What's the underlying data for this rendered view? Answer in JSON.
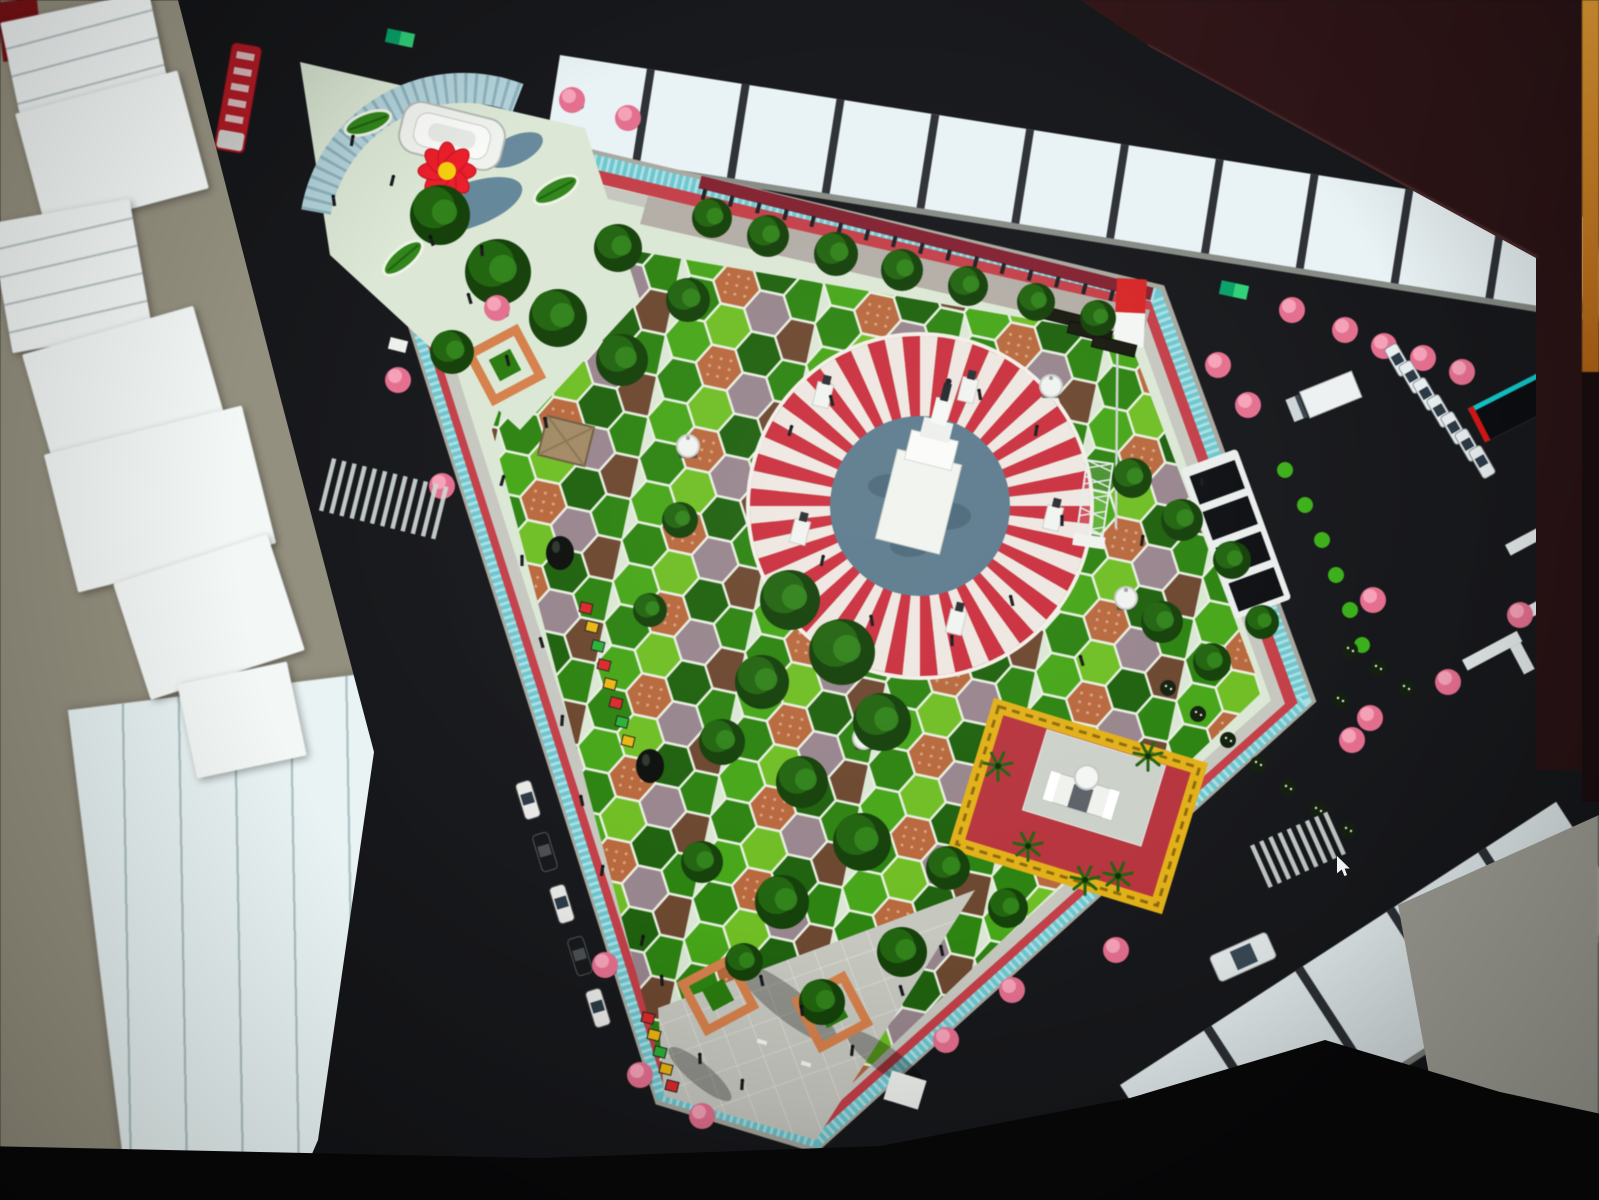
{
  "scene": {
    "type": "photograph of a monitor displaying a 3D aerial render of a town-square park",
    "cursor": {
      "x": 1337,
      "y": 856
    }
  },
  "colors": {
    "room_tan": "#94907f",
    "paper": "#f3f7f6",
    "lined_paper": "#e9f3f3",
    "lined_paper_line": "#a4b8bc",
    "asphalt": "#17181b",
    "building_white": "#e9f2f4",
    "building_gap": "#2d3136",
    "curb": "#9aa098",
    "sidewalk": "#a8a89f",
    "teal_strip": "#6fc6ce",
    "teal_dash": "#eaf6f6",
    "track_red": "#bf4049",
    "walk_light": "#c6c8c0",
    "mint": "#dce8d6",
    "wall_red": "#7e2230",
    "path_gray": "#b3ada6",
    "plaza_gray": "#c6c8c0",
    "grid_line": "#e8eae4",
    "hex_bright": "#49a51d",
    "hex_mid": "#2f8214",
    "hex_dark": "#206010",
    "hex_lime": "#71bd2a",
    "hex_terra": "#b5693f",
    "hex_mauve": "#97858d",
    "hex_brown": "#6b4730",
    "hex_grout": "#e9f0e4",
    "sun_red": "#c5313f",
    "sun_white": "#efe7e1",
    "pool": "#5d7b8c",
    "pool_dark": "#46616f",
    "monument": "#f2f4f0",
    "gate_red": "#b2353f",
    "gate_yellow": "#e0b01f",
    "court_gray": "#ccd1ca",
    "tree_dark": "#153f0b",
    "tree_mid": "#236312",
    "tree_light": "#358420",
    "pink": "#e0708f",
    "pink_light": "#f2a3b8",
    "flag_red": "#d02828",
    "white": "#f2f4f2",
    "amph_blue": "#b5d3da",
    "amph_dash": "#6f97a2",
    "pond": "#5b7f95",
    "cursor_white": "#f5f7f7",
    "billboard_teal": "#19c8c8",
    "billboard_red": "#d01818",
    "sign_green_a": "#0fa06a",
    "sign_green_b": "#35d07a",
    "bus_red": "#b51e28",
    "stall_red": "#d42b2b",
    "stall_yellow": "#e8b619",
    "stall_green": "#2fae3a",
    "planter_orange": "#d2814e",
    "roof_tan": "#a08a66",
    "dark_struct": "#17190f"
  },
  "park": {
    "pent": [
      [
        340,
        95
      ],
      [
        1160,
        290
      ],
      [
        1310,
        700
      ],
      [
        815,
        1147
      ],
      [
        660,
        1100
      ]
    ],
    "teal": [
      [
        348,
        103
      ],
      [
        1155,
        296
      ],
      [
        1303,
        700
      ],
      [
        816,
        1140
      ],
      [
        663,
        1094
      ]
    ],
    "red": [
      [
        363,
        121
      ],
      [
        1146,
        307
      ],
      [
        1290,
        701
      ],
      [
        817,
        1125
      ],
      [
        669,
        1081
      ]
    ],
    "walk": [
      [
        376,
        139
      ],
      [
        1139,
        316
      ],
      [
        1278,
        702
      ],
      [
        818,
        1113
      ],
      [
        674,
        1070
      ]
    ],
    "hexf": [
      [
        560,
        238
      ],
      [
        1128,
        336
      ],
      [
        1262,
        692
      ],
      [
        816,
        1118
      ],
      [
        660,
        1062
      ],
      [
        492,
        430
      ]
    ],
    "mintp": [
      [
        300,
        62
      ],
      [
        585,
        128
      ],
      [
        640,
        300
      ],
      [
        520,
        430
      ],
      [
        330,
        255
      ]
    ],
    "nepath": [
      [
        648,
        196
      ],
      [
        1150,
        310
      ],
      [
        1142,
        338
      ],
      [
        640,
        224
      ]
    ],
    "splaza": [
      [
        658,
        1008
      ],
      [
        975,
        890
      ],
      [
        816,
        1140
      ],
      [
        664,
        1096
      ]
    ],
    "wall": [
      700,
      182,
      1152,
      294
    ],
    "circle": {
      "cx": 920,
      "cy": 506,
      "r_out": 170,
      "r_pool": 90
    }
  },
  "buildings": {
    "top": {
      "x": 560,
      "y": 55,
      "rot": 9,
      "len": 1100,
      "h": 95,
      "block": 88,
      "gap": 8
    },
    "bottom": {
      "x": 1120,
      "y": 1085,
      "rot": -33,
      "len": 520,
      "h": 135,
      "block": 100,
      "gap": 9
    }
  },
  "trees_dark": [
    [
      440,
      215,
      30
    ],
    [
      498,
      272,
      33
    ],
    [
      558,
      318,
      29
    ],
    [
      622,
      360,
      26
    ],
    [
      452,
      352,
      22
    ],
    [
      618,
      248,
      24
    ],
    [
      688,
      300,
      22
    ],
    [
      712,
      218,
      20
    ],
    [
      768,
      236,
      21
    ],
    [
      836,
      254,
      22
    ],
    [
      902,
      270,
      21
    ],
    [
      968,
      286,
      20
    ],
    [
      1036,
      302,
      19
    ],
    [
      1098,
      318,
      18
    ],
    [
      790,
      600,
      30
    ],
    [
      842,
      652,
      33
    ],
    [
      762,
      682,
      27
    ],
    [
      882,
      722,
      29
    ],
    [
      802,
      782,
      26
    ],
    [
      722,
      742,
      23
    ],
    [
      862,
      842,
      29
    ],
    [
      782,
      902,
      27
    ],
    [
      702,
      862,
      21
    ],
    [
      902,
      952,
      25
    ],
    [
      822,
      1002,
      23
    ],
    [
      744,
      962,
      19
    ],
    [
      1132,
      478,
      20
    ],
    [
      1182,
      520,
      21
    ],
    [
      1232,
      560,
      19
    ],
    [
      1162,
      622,
      21
    ],
    [
      1212,
      662,
      19
    ],
    [
      1262,
      622,
      17
    ],
    [
      948,
      868,
      22
    ],
    [
      1008,
      908,
      20
    ],
    [
      680,
      520,
      18
    ],
    [
      650,
      610,
      17
    ]
  ],
  "trees_pink": [
    [
      572,
      100
    ],
    [
      628,
      118
    ],
    [
      398,
      380
    ],
    [
      442,
      486
    ],
    [
      605,
      965
    ],
    [
      640,
      1075
    ],
    [
      702,
      1116
    ],
    [
      946,
      1040
    ],
    [
      1012,
      990
    ],
    [
      1116,
      950
    ],
    [
      1218,
      365
    ],
    [
      1248,
      405
    ],
    [
      1292,
      310
    ],
    [
      1345,
      330
    ],
    [
      1384,
      346
    ],
    [
      1423,
      358
    ],
    [
      1462,
      372
    ],
    [
      1373,
      600
    ],
    [
      1352,
      740
    ],
    [
      1448,
      682
    ],
    [
      1520,
      615
    ],
    [
      1552,
      600
    ],
    [
      1370,
      718
    ],
    [
      497,
      308
    ]
  ],
  "shrubs_bright": [
    [
      1285,
      470
    ],
    [
      1305,
      505
    ],
    [
      1322,
      540
    ],
    [
      1336,
      575
    ],
    [
      1350,
      610
    ],
    [
      1362,
      645
    ]
  ],
  "shrubs_dark": [
    [
      1168,
      688
    ],
    [
      1198,
      714
    ],
    [
      1228,
      740
    ],
    [
      1258,
      764
    ],
    [
      1288,
      788
    ],
    [
      1318,
      810
    ],
    [
      1348,
      830
    ],
    [
      1350,
      650
    ],
    [
      1378,
      668
    ],
    [
      1406,
      688
    ],
    [
      1340,
      700
    ],
    [
      1368,
      718
    ]
  ],
  "palms": [
    [
      998,
      766
    ],
    [
      1028,
      846
    ],
    [
      1118,
      876
    ],
    [
      1148,
      756
    ],
    [
      1085,
      880
    ]
  ],
  "people": [
    [
      352,
      142
    ],
    [
      392,
      182
    ],
    [
      334,
      202
    ],
    [
      432,
      242
    ],
    [
      470,
      300
    ],
    [
      508,
      362
    ],
    [
      482,
      252
    ],
    [
      546,
      424
    ],
    [
      502,
      482
    ],
    [
      522,
      562
    ],
    [
      542,
      644
    ],
    [
      562,
      722
    ],
    [
      582,
      802
    ],
    [
      602,
      872
    ],
    [
      790,
      432
    ],
    [
      832,
      402
    ],
    [
      980,
      396
    ],
    [
      1036,
      432
    ],
    [
      1062,
      522
    ],
    [
      1012,
      602
    ],
    [
      952,
      642
    ],
    [
      872,
      622
    ],
    [
      822,
      562
    ],
    [
      762,
      982
    ],
    [
      802,
      1012
    ],
    [
      852,
      1052
    ],
    [
      902,
      992
    ],
    [
      942,
      952
    ],
    [
      1082,
      662
    ],
    [
      1142,
      542
    ],
    [
      1202,
      482
    ],
    [
      642,
      942
    ],
    [
      662,
      982
    ],
    [
      700,
      1060
    ],
    [
      742,
      1086
    ]
  ],
  "pedestals": [
    [
      823,
      395
    ],
    [
      968,
      390
    ],
    [
      800,
      532
    ],
    [
      1053,
      518
    ],
    [
      956,
      622
    ]
  ],
  "gazebos_dome": [
    [
      688,
      446
    ],
    [
      1051,
      386
    ],
    [
      1126,
      598
    ],
    [
      864,
      738
    ]
  ],
  "black_domes": [
    [
      560,
      553
    ],
    [
      650,
      766
    ]
  ],
  "leaf_planters": [
    [
      368,
      123,
      -20
    ],
    [
      403,
      258,
      -40
    ],
    [
      556,
      190,
      -28
    ]
  ],
  "planters_diamond": [
    [
      718,
      995
    ],
    [
      832,
      1012
    ],
    [
      505,
      365
    ]
  ],
  "stall_rows": [
    {
      "x": 586,
      "y": 608,
      "dx": 6,
      "dy": 19,
      "colors": [
        "stall_red",
        "stall_yellow",
        "stall_green",
        "stall_red",
        "stall_yellow",
        "stall_red",
        "stall_green",
        "stall_yellow"
      ]
    },
    {
      "x": 648,
      "y": 1018,
      "dx": 6,
      "dy": 17,
      "colors": [
        "stall_red",
        "stall_yellow",
        "stall_green",
        "stall_yellow",
        "stall_red"
      ]
    }
  ],
  "stage_rows": [
    [
      1066,
      318
    ],
    [
      1090,
      332
    ],
    [
      1114,
      346
    ]
  ],
  "benches": [
    [
      762,
      1042
    ],
    [
      806,
      1064
    ],
    [
      726,
      1000
    ]
  ],
  "white_sign_plaza": [
    905,
    1090
  ],
  "kiosk": [
    398,
    345
  ],
  "shadow_blobs": [
    [
      788,
      1004,
      62,
      16,
      38
    ],
    [
      886,
      1060,
      48,
      13,
      36
    ],
    [
      700,
      1074,
      40,
      11,
      40
    ]
  ],
  "grid_lines_a": {
    "x0": 600,
    "y0": 860,
    "dx": 120,
    "dy": 320,
    "step": 30,
    "n": 9
  },
  "grid_lines_b": {
    "x0": 640,
    "y0": 930,
    "dx": 340,
    "dy": -120,
    "step": 34,
    "n": 7
  },
  "vehicles": {
    "bus": {
      "x": 238,
      "y": 98,
      "rot": 10
    },
    "van": {
      "x": 1243,
      "y": 957,
      "rot": -24
    },
    "truck": {
      "x": 1327,
      "y": 396,
      "rot": 68
    },
    "parked_right": {
      "x": 1398,
      "y": 360,
      "dx": 14,
      "dy": 17,
      "count": 7,
      "rot": 60
    },
    "parked_left": {
      "pts": [
        [
          528,
          800
        ],
        [
          545,
          852
        ],
        [
          562,
          904
        ],
        [
          580,
          956
        ],
        [
          598,
          1008
        ]
      ],
      "rot": 73,
      "colors": [
        "#e8e8e6",
        "#17181b",
        "#e8e8e6",
        "#17181b",
        "#e8e8e6"
      ]
    }
  },
  "crosswalks": [
    {
      "x": 332,
      "y": 458,
      "rot": 14,
      "bars": 12,
      "w": 4.5,
      "h": 54,
      "step": 10.5
    },
    {
      "x": 1250,
      "y": 846,
      "rot": -24,
      "bars": 9,
      "w": 4.5,
      "h": 46,
      "step": 10
    }
  ],
  "flag": {
    "x": 1117,
    "y": 278,
    "w": 30,
    "h": 68
  },
  "tower": {
    "x": 1100,
    "y": 462,
    "rot": 8
  },
  "billboard": {
    "x": 1513,
    "y": 407,
    "rot": 63
  },
  "signs": [
    [
      400,
      38,
      12
    ],
    [
      1234,
      290,
      12
    ]
  ],
  "l_walks": [
    [
      1505,
      545,
      -28
    ],
    [
      1520,
      610,
      -28
    ],
    [
      1462,
      660,
      -28
    ]
  ],
  "gate": {
    "x": 1078,
    "y": 806,
    "rot": 17
  },
  "pergola": {
    "x": 1236,
    "y": 534,
    "rot": 70
  },
  "gazebo_cream": {
    "x": 566,
    "y": 441,
    "rot": 14
  },
  "flower": {
    "x": 447,
    "y": 171
  },
  "tiered_building": {
    "x": 452,
    "y": 136,
    "rot": 14
  },
  "room": {
    "papers": [
      [
        8,
        6,
        152,
        92,
        -12,
        1
      ],
      [
        28,
        90,
        168,
        122,
        -15,
        0
      ],
      [
        0,
        210,
        142,
        132,
        -10,
        1
      ],
      [
        34,
        328,
        178,
        112,
        -16,
        0
      ],
      [
        58,
        428,
        204,
        142,
        -14,
        0
      ],
      [
        128,
        556,
        162,
        122,
        -18,
        0
      ],
      [
        186,
        672,
        112,
        96,
        -12,
        0
      ]
    ],
    "red_object": [
      0,
      0,
      40,
      60,
      -6
    ],
    "lined_sheet": [
      96,
      690,
      300,
      480,
      -7
    ]
  }
}
